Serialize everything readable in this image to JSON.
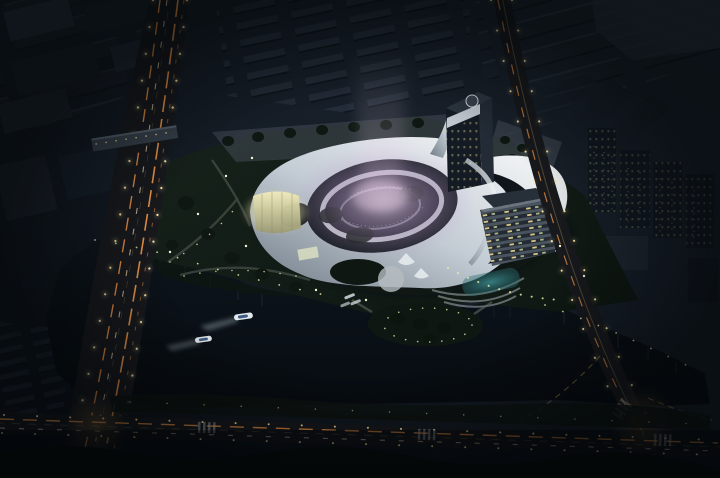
{
  "scene": {
    "type": "aerial-night-architectural-rendering",
    "subject": "flowing white-roof cultural center with oval courtyard light show, tower with helipad, hotel block, lakefront park and city fabric at night",
    "time_of_day": "night",
    "boats_on_lake": 2,
    "light_show": "purple-pink illuminated mist rising from the oval sunken courtyard",
    "objects": [
      "city-blocks-northwest",
      "row-housing-north",
      "warehouses-northeast",
      "residential-towers-east",
      "elevated-highway",
      "pedestrian-bridge",
      "avenue-east",
      "boulevard-south",
      "crosswalks",
      "cultural-center-roof",
      "central-courtyard",
      "entry-pavilion",
      "observation-tower",
      "helipad",
      "hotel-building",
      "swimming-pool",
      "north-plaza",
      "lakefront-park",
      "peninsula-island",
      "lake",
      "motor-boats",
      "dock-boats",
      "street-lights",
      "car-light-trails",
      "tree-lights"
    ]
  },
  "colors": {
    "sky_base": "#0e141c",
    "sky_top_right": "#1d2631",
    "block_dark": "#1a222b",
    "block_roof": "#28313d",
    "warehouse": "#20272f",
    "road_surface": "#17191d",
    "street_light": "#ffe9a4",
    "car_trail_warm": "#ff9e4a",
    "car_trail_white": "#ffe6c2",
    "lane_line": "#8a7a4e",
    "lake_top": "#0d151d",
    "lake_bottom": "#070c11",
    "park_green": "#17221b",
    "park_green_dark": "#0e1712",
    "tree_light": "#e9ecaa",
    "roof_white": "#ffffff",
    "roof_mid": "#c3ccd4",
    "roof_shadow": "#6f7a85",
    "courtyard_dark": "#1b2026",
    "glow_purple": "#b795c9",
    "glow_pink": "#ecd2ec",
    "pavilion_glass": "#f2ecbc",
    "tower_facade": "#141b24",
    "tower_side": "#232c36",
    "window_warm": "#d8c98a",
    "hotel_band_dark": "#232a33",
    "hotel_band_light": "#4a545e",
    "pool_teal": "#2a6a70",
    "plaza_grey": "#454e59",
    "water_reflection": "#2c3d47",
    "crosswalk": "#b9bfc6",
    "boat_hull": "#e3e9ee",
    "boat_deck": "#3d5c82"
  }
}
